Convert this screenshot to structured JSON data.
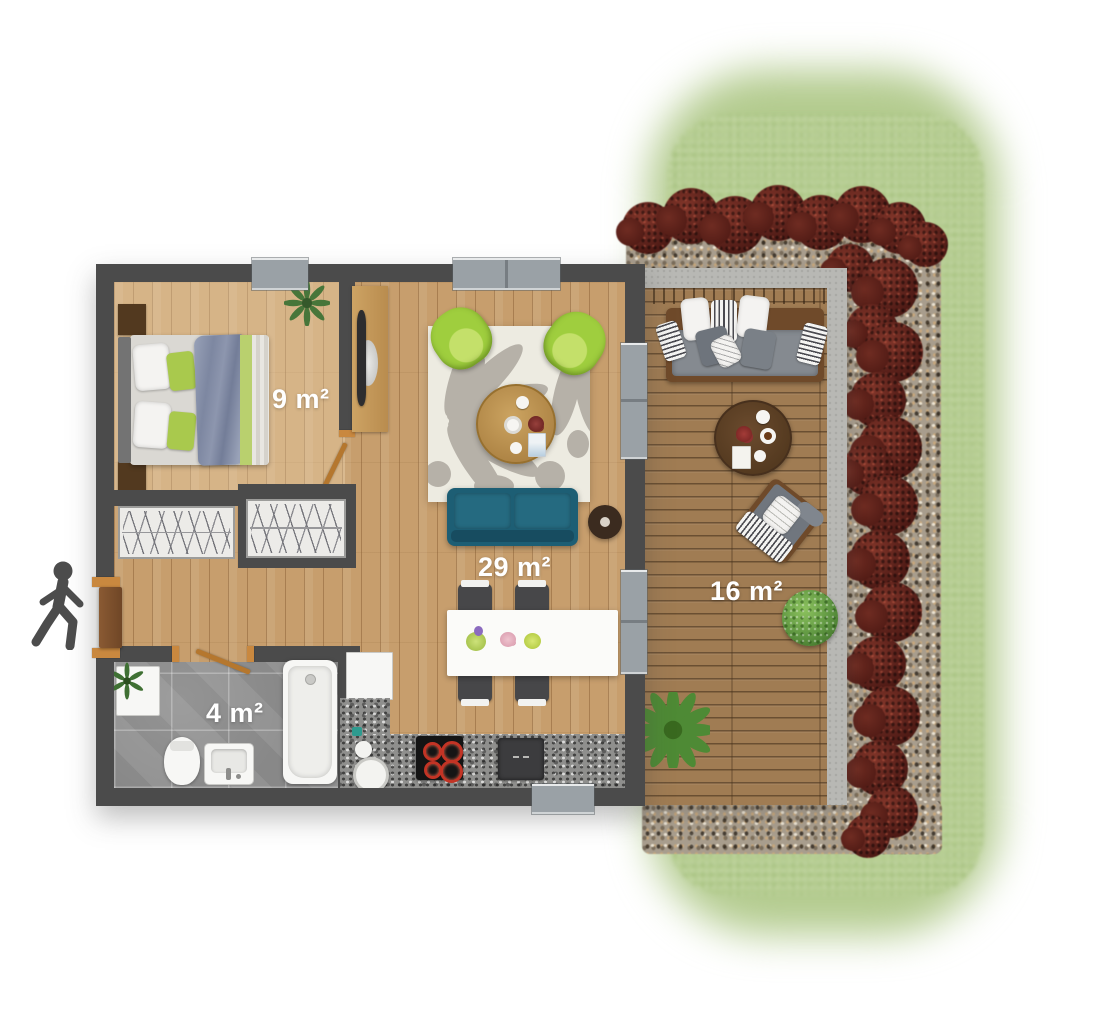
{
  "plan": {
    "rooms": [
      {
        "id": "bedroom",
        "area_label": "9 m²"
      },
      {
        "id": "living-room",
        "area_label": "29 m²"
      },
      {
        "id": "bathroom",
        "area_label": "4 m²"
      },
      {
        "id": "terrace",
        "area_label": "16 m²"
      }
    ],
    "icons": [
      {
        "name": "walking-person-icon",
        "meaning": "entrance"
      }
    ]
  },
  "colors": {
    "wall": "#4b4b4b",
    "floor_wood": "#c79e6d",
    "deck_wood": "#a07c53",
    "tile_grey": "#929292",
    "granite": "#8f8f8d",
    "sofa_teal": "#1d5e74",
    "armchair_green": "#9fce3e",
    "bed_green": "#a9c94d",
    "rug_cream": "#edebe1",
    "grass_green": "#b3cb8e",
    "bush_maroon": "#5e231c",
    "gravel": "#a89d8d",
    "concrete": "#b8b8b4",
    "door_frame_orange": "#c9883f",
    "label_white": "#ffffff"
  }
}
